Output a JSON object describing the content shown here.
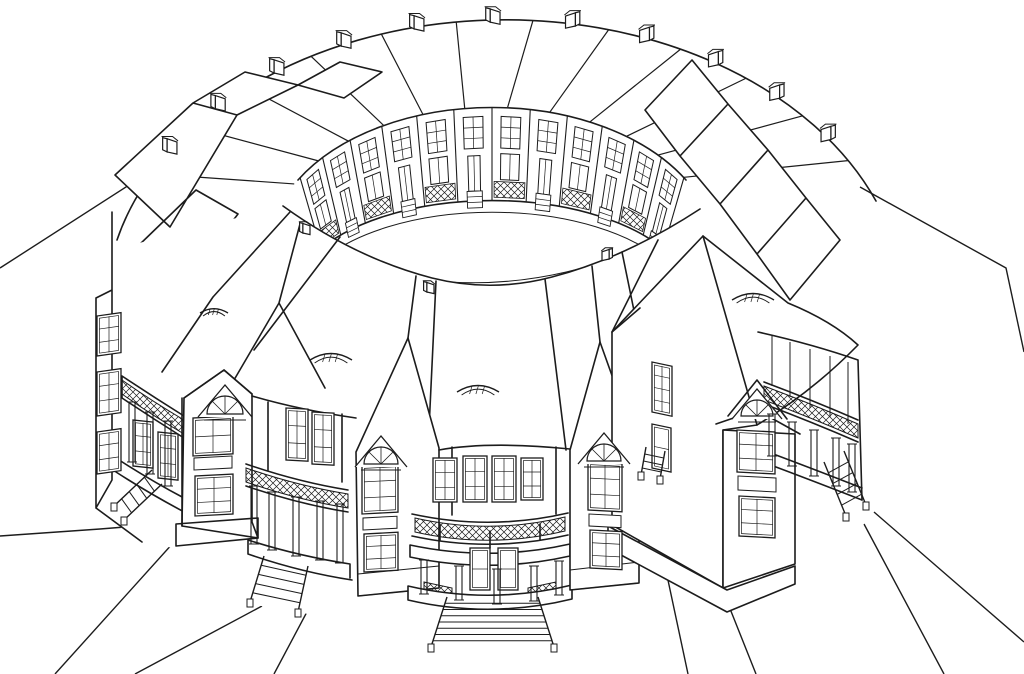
{
  "meta": {
    "description": "Black-and-white axonometric pen drawing of a circular residential building: a ring of two-story row houses with gabled and hipped roofs, chimneys along the outer ridge, an inner circular courtyard lined with sash windows, doors, stoops and lattice porches, curved balconied porches and grand entrance stairs on the outside, and footpaths radiating outward on open ground.",
    "paper_color": "#ffffff",
    "ink_color": "#1c1c1c"
  },
  "drawing": {
    "ellipses": {
      "ridge": {
        "cx": 505,
        "cy": 310,
        "rx": 400,
        "ry": 290
      },
      "facade_top": {
        "cx": 492,
        "cy": 252,
        "rx": 224,
        "ry": 145
      },
      "facade_base": {
        "cx": 492,
        "cy": 300,
        "rx": 200,
        "ry": 100
      }
    },
    "far_roof": {
      "radial_thetas": [
        152,
        141,
        130,
        119,
        108,
        97,
        86,
        75,
        64,
        53,
        42,
        31
      ],
      "chimney_thetas": [
        146.5,
        135.5,
        124.5,
        113.5,
        102.5,
        91.5,
        80.5,
        69.5,
        58.5,
        47.5,
        36.5
      ]
    },
    "facade": {
      "theta_start": 149,
      "theta_end": 31,
      "bays": 12
    },
    "rim_chimneys": [
      [
        306,
        233
      ],
      [
        430,
        292
      ],
      [
        606,
        259
      ]
    ],
    "eyebrow_dormers": [
      [
        214,
        313,
        14
      ],
      [
        331,
        360,
        21
      ],
      [
        478,
        392,
        21
      ],
      [
        753,
        300,
        21
      ]
    ],
    "arched_dormers": [
      [
        225,
        414,
        18
      ],
      [
        381,
        464,
        17
      ],
      [
        604,
        461,
        17
      ],
      [
        757,
        416,
        16
      ]
    ],
    "windows": [
      [
        97,
        316,
        24,
        40,
        2,
        3,
        -8
      ],
      [
        97,
        372,
        24,
        44,
        2,
        3,
        -8
      ],
      [
        97,
        432,
        24,
        42,
        2,
        3,
        -8
      ],
      [
        133,
        420,
        20,
        46,
        2,
        3,
        6
      ],
      [
        158,
        432,
        20,
        46,
        2,
        3,
        6
      ],
      [
        193,
        418,
        40,
        38,
        2,
        2,
        -3
      ],
      [
        195,
        476,
        38,
        40,
        2,
        3,
        -3
      ],
      [
        286,
        408,
        22,
        52,
        2,
        3,
        3
      ],
      [
        312,
        412,
        22,
        52,
        2,
        3,
        3
      ],
      [
        362,
        466,
        36,
        48,
        2,
        3,
        -3
      ],
      [
        364,
        534,
        34,
        38,
        2,
        3,
        -3
      ],
      [
        433,
        458,
        24,
        44,
        2,
        3,
        0
      ],
      [
        463,
        456,
        24,
        46,
        2,
        3,
        0
      ],
      [
        492,
        456,
        24,
        46,
        2,
        3,
        0
      ],
      [
        521,
        458,
        22,
        42,
        2,
        3,
        0
      ],
      [
        470,
        548,
        20,
        42,
        1,
        2,
        0
      ],
      [
        498,
        548,
        20,
        42,
        1,
        2,
        0
      ],
      [
        588,
        462,
        34,
        48,
        2,
        3,
        3
      ],
      [
        590,
        530,
        32,
        38,
        2,
        3,
        3
      ],
      [
        652,
        362,
        20,
        50,
        2,
        4,
        12
      ],
      [
        652,
        424,
        19,
        44,
        1,
        2,
        12
      ],
      [
        737,
        430,
        38,
        42,
        2,
        3,
        3
      ],
      [
        739,
        496,
        36,
        40,
        2,
        3,
        3
      ]
    ],
    "panels": [
      [
        363,
        518,
        34,
        12,
        -3
      ],
      [
        589,
        514,
        32,
        12,
        3
      ],
      [
        738,
        476,
        38,
        14,
        3
      ],
      [
        194,
        458,
        38,
        12,
        -3
      ]
    ],
    "columns": [
      [
        132,
        402,
        462
      ],
      [
        150,
        412,
        474
      ],
      [
        168,
        421,
        486
      ],
      [
        254,
        486,
        544
      ],
      [
        272,
        492,
        550
      ],
      [
        296,
        497,
        556
      ],
      [
        320,
        501,
        560
      ],
      [
        340,
        504,
        563
      ],
      [
        424,
        560,
        594
      ],
      [
        459,
        566,
        600
      ],
      [
        497,
        569,
        604
      ],
      [
        534,
        566,
        601
      ],
      [
        559,
        561,
        595
      ],
      [
        772,
        414,
        456
      ],
      [
        792,
        422,
        466
      ],
      [
        814,
        430,
        476
      ],
      [
        836,
        438,
        486
      ],
      [
        852,
        444,
        492
      ]
    ],
    "mullions": [
      [
        772,
        336,
        386
      ],
      [
        790,
        342,
        397
      ],
      [
        810,
        349,
        408
      ],
      [
        830,
        356,
        417
      ],
      [
        848,
        362,
        424
      ]
    ],
    "stairs": [
      {
        "railA": [
          [
            152,
            470
          ],
          [
            114,
            506
          ]
        ],
        "railB": [
          [
            162,
            484
          ],
          [
            124,
            520
          ]
        ],
        "steps": 5
      },
      {
        "railA": [
          [
            264,
            556
          ],
          [
            250,
            602
          ]
        ],
        "railB": [
          [
            308,
            566
          ],
          [
            298,
            612
          ]
        ],
        "steps": 5
      },
      {
        "railA": [
          [
            447,
            597
          ],
          [
            431,
            647
          ]
        ],
        "railB": [
          [
            538,
            597
          ],
          [
            554,
            647
          ]
        ],
        "steps": 8
      },
      {
        "railA": [
          [
            646,
            447
          ],
          [
            641,
            475
          ]
        ],
        "railB": [
          [
            665,
            451
          ],
          [
            660,
            479
          ]
        ],
        "steps": 4
      },
      {
        "railA": [
          [
            824,
            462
          ],
          [
            846,
            516
          ]
        ],
        "railB": [
          [
            844,
            451
          ],
          [
            866,
            505
          ]
        ],
        "steps": 5
      }
    ],
    "ground_paths": [
      [
        [
          168,
          160
        ],
        [
          0,
          268
        ]
      ],
      [
        [
          250,
          517
        ],
        [
          100,
          529
        ],
        [
          0,
          536
        ]
      ],
      [
        [
          183,
          532
        ],
        [
          55,
          674
        ]
      ],
      [
        [
          262,
          606
        ],
        [
          135,
          674
        ]
      ],
      [
        [
          317,
          593
        ],
        [
          274,
          674
        ]
      ],
      [
        [
          646,
          477
        ],
        [
          688,
          674
        ]
      ],
      [
        [
          670,
          458
        ],
        [
          756,
          674
        ]
      ],
      [
        [
          864,
          524
        ],
        [
          944,
          674
        ]
      ],
      [
        [
          874,
          512
        ],
        [
          1024,
          642
        ]
      ],
      [
        [
          860,
          187
        ],
        [
          1006,
          268
        ],
        [
          1024,
          352
        ]
      ]
    ]
  }
}
